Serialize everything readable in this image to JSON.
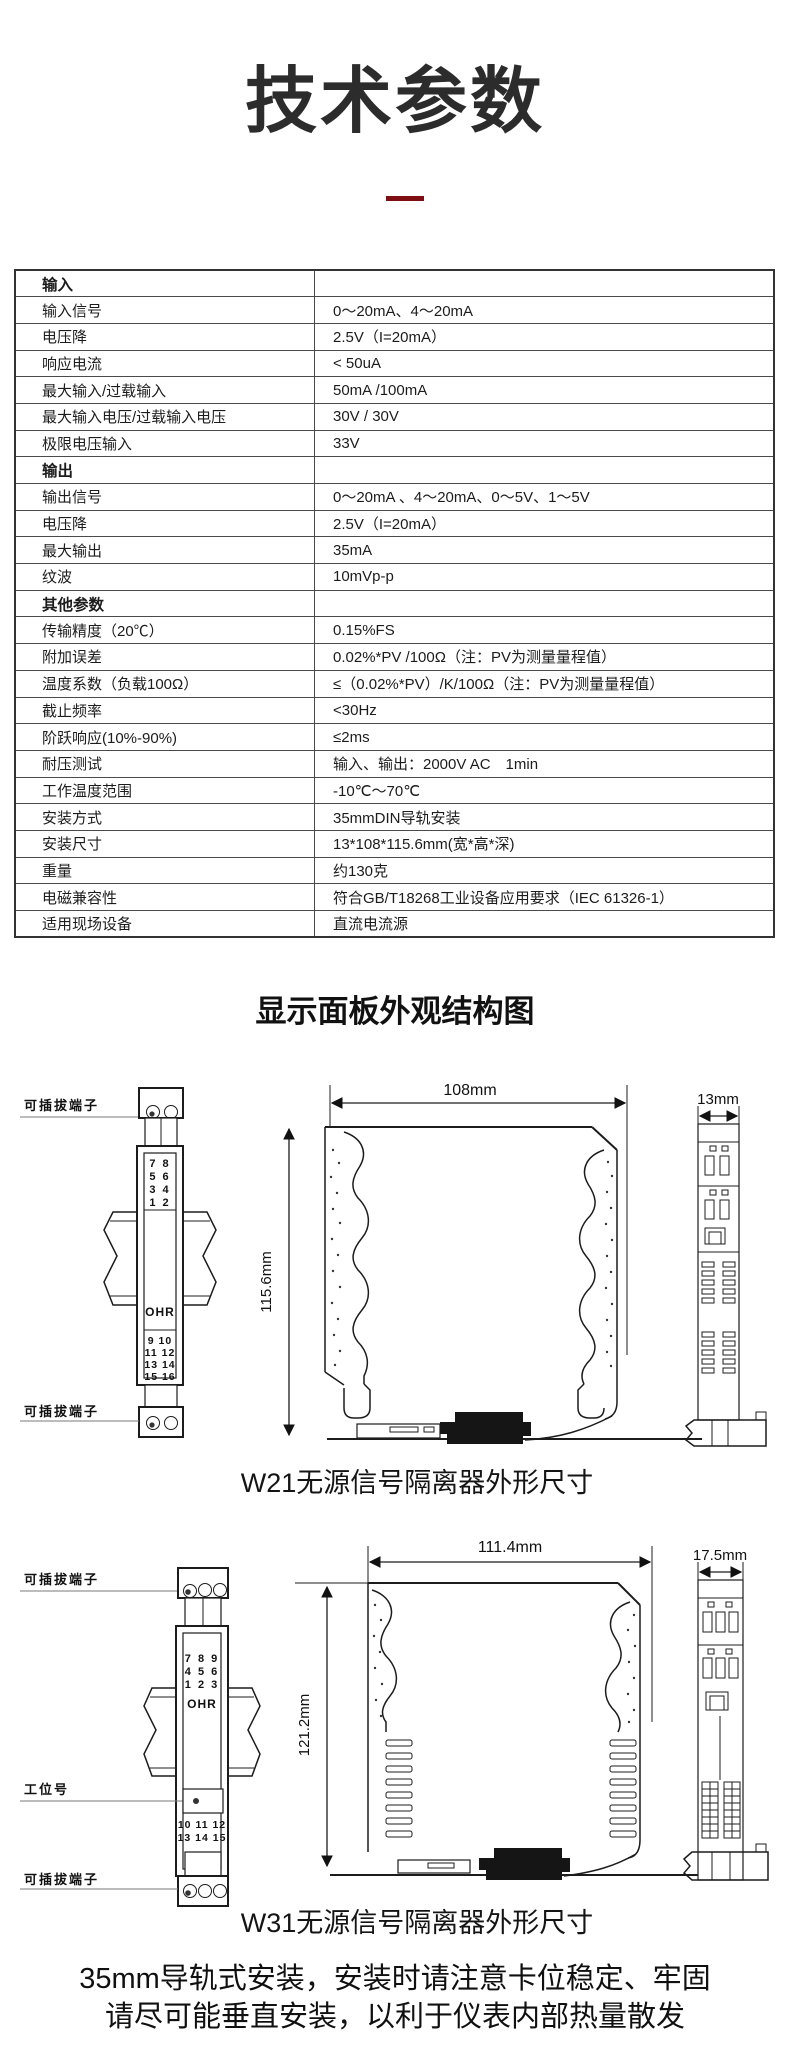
{
  "page": {
    "title": "技术参数",
    "section2_title": "显示面板外观结构图",
    "footer_line1": "35mm导轨式安装，安装时请注意卡位稳定、牢固",
    "footer_line2": "请尽可能垂直安装，以利于仪表内部热量散发",
    "accent_color": "#7d0f12"
  },
  "spec_table": {
    "rows": [
      {
        "label": "输入",
        "value": ""
      },
      {
        "label": "输入信号",
        "value": "0～20mA、4～20mA"
      },
      {
        "label": "电压降",
        "value": "2.5V（I=20mA）"
      },
      {
        "label": "响应电流",
        "value": "< 50uA"
      },
      {
        "label": "最大输入/过载输入",
        "value": "50mA /100mA"
      },
      {
        "label": "最大输入电压/过载输入电压",
        "value": "30V / 30V"
      },
      {
        "label": "极限电压输入",
        "value": "33V"
      },
      {
        "label": "输出",
        "value": ""
      },
      {
        "label": "输出信号",
        "value": "0～20mA 、4～20mA、0～5V、1～5V"
      },
      {
        "label": "电压降",
        "value": "2.5V（I=20mA）"
      },
      {
        "label": "最大输出",
        "value": "35mA"
      },
      {
        "label": "纹波",
        "value": "10mVp-p"
      },
      {
        "label": "其他参数",
        "value": ""
      },
      {
        "label": "传输精度（20℃）",
        "value": "0.15%FS"
      },
      {
        "label": "附加误差",
        "value": "0.02%*PV /100Ω（注：PV为测量量程值）"
      },
      {
        "label": "温度系数（负载100Ω）",
        "value": "≤（0.02%*PV）/K/100Ω（注：PV为测量量程值）"
      },
      {
        "label": "截止频率",
        "value": "<30Hz"
      },
      {
        "label": "阶跃响应(10%-90%)",
        "value": "≤2ms"
      },
      {
        "label": "耐压测试",
        "value": "输入、输出：2000V AC　1min"
      },
      {
        "label": "工作温度范围",
        "value": "-10℃～70℃"
      },
      {
        "label": "安装方式",
        "value": "35mmDIN导轨安装"
      },
      {
        "label": "安装尺寸",
        "value": "13*108*115.6mm(宽*高*深)"
      },
      {
        "label": "重量",
        "value": "约130克"
      },
      {
        "label": "电磁兼容性",
        "value": "符合GB/T18268工业设备应用要求（IEC 61326-1）"
      },
      {
        "label": "适用现场设备",
        "value": "直流电流源"
      }
    ]
  },
  "diagram_w21": {
    "caption": "W21无源信号隔离器外形尺寸",
    "brand": "OHR",
    "labels": {
      "pluggable_terminal": "可插拔端子"
    },
    "dims": {
      "width": "108mm",
      "height": "115.6mm",
      "depth": "13mm"
    },
    "terminals_top": [
      "7 8",
      "5 6",
      "3 4",
      "1 2"
    ],
    "terminals_bottom": [
      "9 10",
      "11 12",
      "13 14",
      "15 16"
    ]
  },
  "diagram_w31": {
    "caption": "W31无源信号隔离器外形尺寸",
    "brand": "OHR",
    "labels": {
      "pluggable_terminal": "可插拔端子",
      "station_tag": "工位号"
    },
    "dims": {
      "width": "111.4mm",
      "height": "121.2mm",
      "depth": "17.5mm"
    },
    "terminals_top": [
      "7 8 9",
      "4 5 6",
      "1 2 3"
    ],
    "terminals_bottom": [
      "10 11 12",
      "13 14 15"
    ]
  }
}
